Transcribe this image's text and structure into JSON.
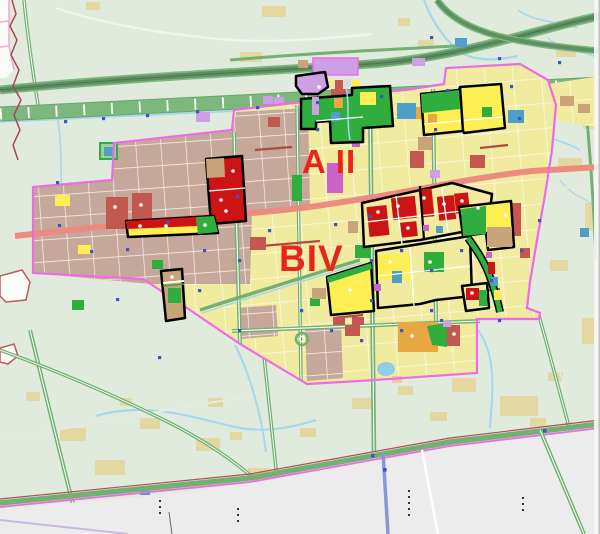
{
  "map": {
    "labels": {
      "district_a": "A II",
      "district_b": "BIV"
    },
    "palette": {
      "rural-base": "#e1ebdd",
      "field-tan": "#e3d8a2",
      "outside-gray": "#ececec",
      "urban-yellow": "#f1eba0",
      "urban-tan": "#c5a89a",
      "parcel-red": "#cd1414",
      "parcel-red-muted": "#c2584f",
      "parcel-orange": "#e9a743",
      "parcel-yellow": "#fdee54",
      "parcel-green": "#2fae3e",
      "parcel-purple": "#cb63cb",
      "parcel-lavender": "#cf9fe6",
      "parcel-teal": "#4f9fc9",
      "parcel-tan": "#c9a37a",
      "cell-gray": "#d9d9d9",
      "cell-peach": "#f0c8a0",
      "pond-blue": "#8fcde8",
      "road-salmon": "#ec8b7e",
      "road-green": "#74b074",
      "road-dark-green": "#5f9063",
      "corridor-green": "#7cb87c",
      "boundary-magenta": "#ee6ae6",
      "water-blue": "#a6d6f0",
      "marker-blue": "#3d56c5",
      "street-white": "#ffffff",
      "minor-road-red": "#b14a42",
      "admin-red": "#a5485c",
      "zone-black": "#000000",
      "label-red": "#e9251b"
    }
  }
}
